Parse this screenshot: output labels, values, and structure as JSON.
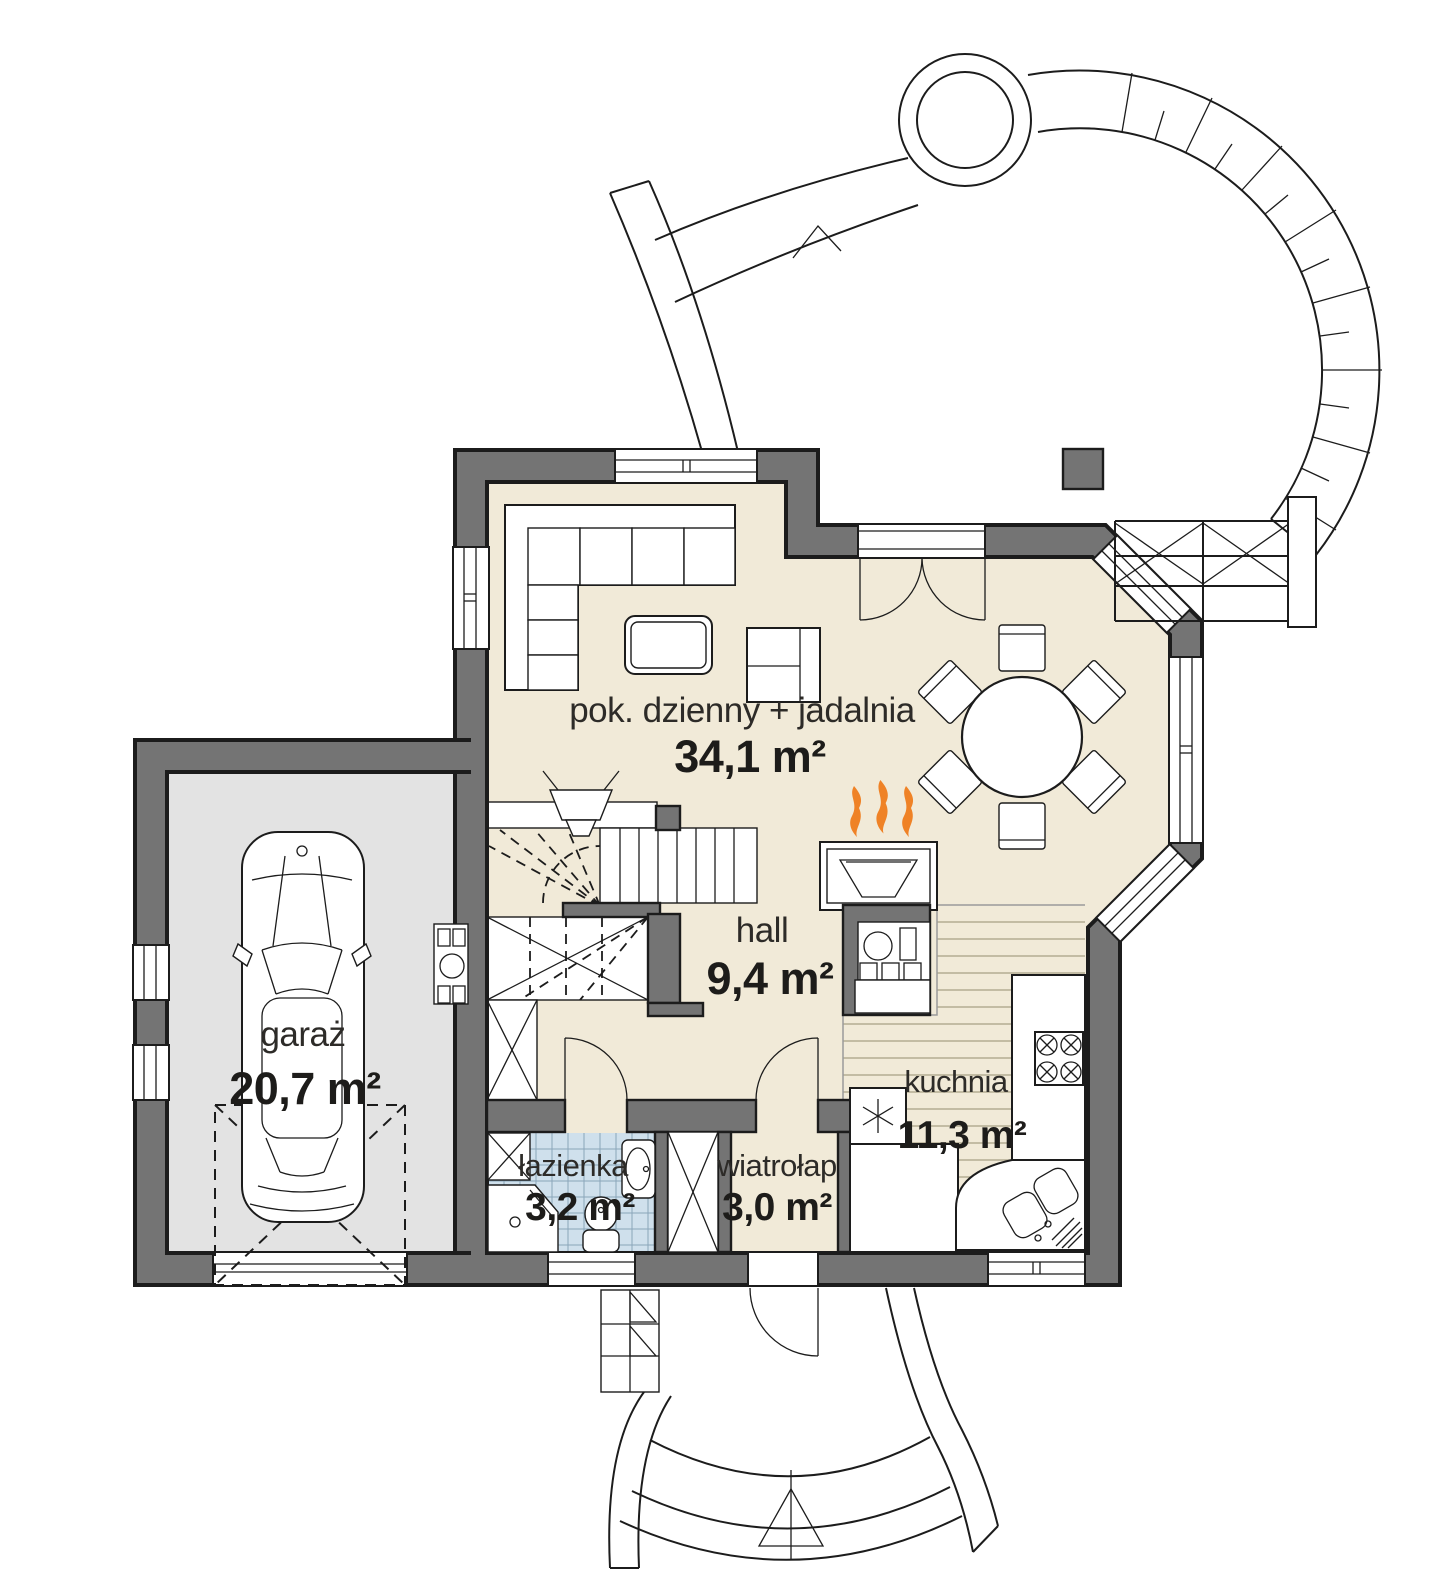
{
  "plan": {
    "kind": "house-ground-floor-plan",
    "language": "pl",
    "rooms": [
      {
        "id": "living-dining",
        "name": "pok. dzienny + jadalnia",
        "area": "34,1 m²"
      },
      {
        "id": "hall",
        "name": "hall",
        "area": "9,4 m²"
      },
      {
        "id": "garage",
        "name": "garaż",
        "area": "20,7 m²"
      },
      {
        "id": "bathroom",
        "name": "łazienka",
        "area": "3,2 m²"
      },
      {
        "id": "vestibule",
        "name": "wiatrołap",
        "area": "3,0 m²"
      },
      {
        "id": "kitchen",
        "name": "kuchnia",
        "area": "11,3 m²"
      }
    ],
    "colors": {
      "walls": "#747474",
      "outline": "#1c1c1c",
      "floor_living": "#f1ead8",
      "floor_garage": "#e3e3e3",
      "floor_bathroom_tiles": "#cfe0ec",
      "fireplace_flames": "#ef8226",
      "background": "#ffffff"
    },
    "symbols": {
      "flame-icon": "three orange flames above fireplace",
      "asterisk-icon": "six point star marking freezer in kitchen"
    }
  }
}
